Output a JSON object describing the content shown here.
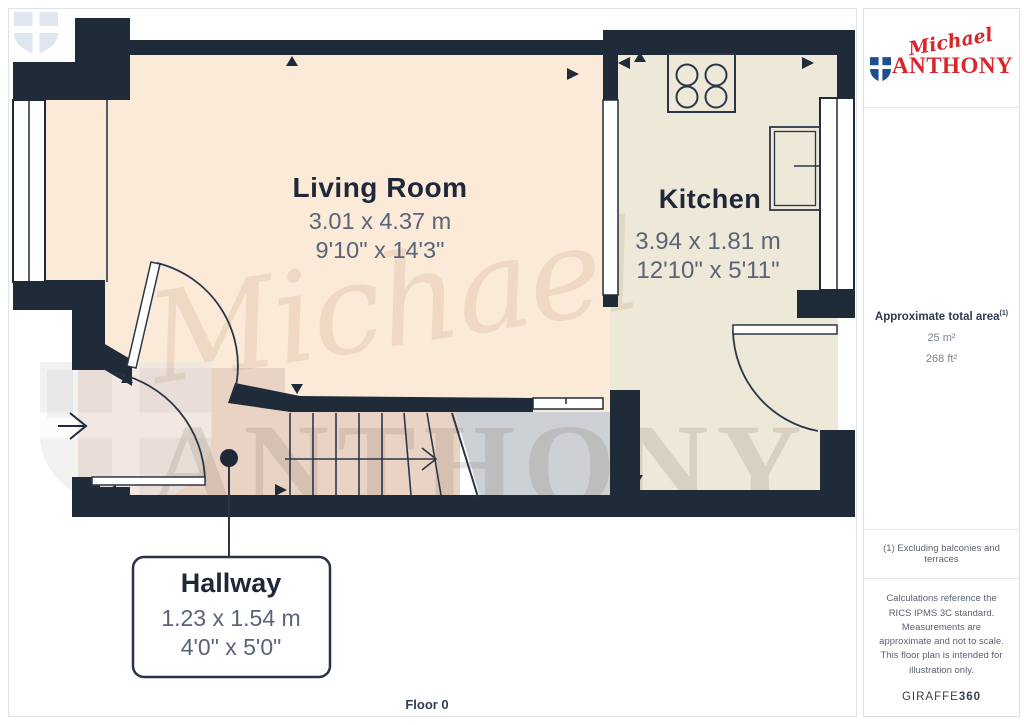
{
  "plan": {
    "floor_label": "Floor 0",
    "watermark": {
      "script": "Michael",
      "caps": "ANTHONY"
    },
    "rooms": [
      {
        "name": "Living Room",
        "metric": "3.01 x 4.37 m",
        "imperial": "9'10\" x 14'3\""
      },
      {
        "name": "Kitchen",
        "metric": "3.94 x 1.81 m",
        "imperial": "12'10\" x 5'11\""
      },
      {
        "name": "Hallway",
        "metric": "1.23 x 1.54 m",
        "imperial": "4'0\" x 5'0\""
      }
    ]
  },
  "sidebar": {
    "logo": {
      "script": "Michael",
      "caps": "ANTHONY"
    },
    "area": {
      "title": "Approximate total area",
      "note_ref": "(1)",
      "metric": "25 m²",
      "imperial": "268 ft²"
    },
    "footnote": "(1) Excluding balconies and terraces",
    "disclaimer": "Calculations reference the RICS IPMS 3C standard. Measurements are approximate and not to scale. This floor plan is intended for illustration only.",
    "brand": {
      "name": "GIRAFFE",
      "suffix": "360"
    }
  },
  "colors": {
    "wall": "#202b3a",
    "living_floor": "#fcead9",
    "kitchen_floor": "#ede8d8",
    "hall_floor": "#e9d3c5",
    "landing_floor": "#cdd0d5",
    "logo_red": "#d8262c",
    "logo_blue": "#1d4f91"
  }
}
